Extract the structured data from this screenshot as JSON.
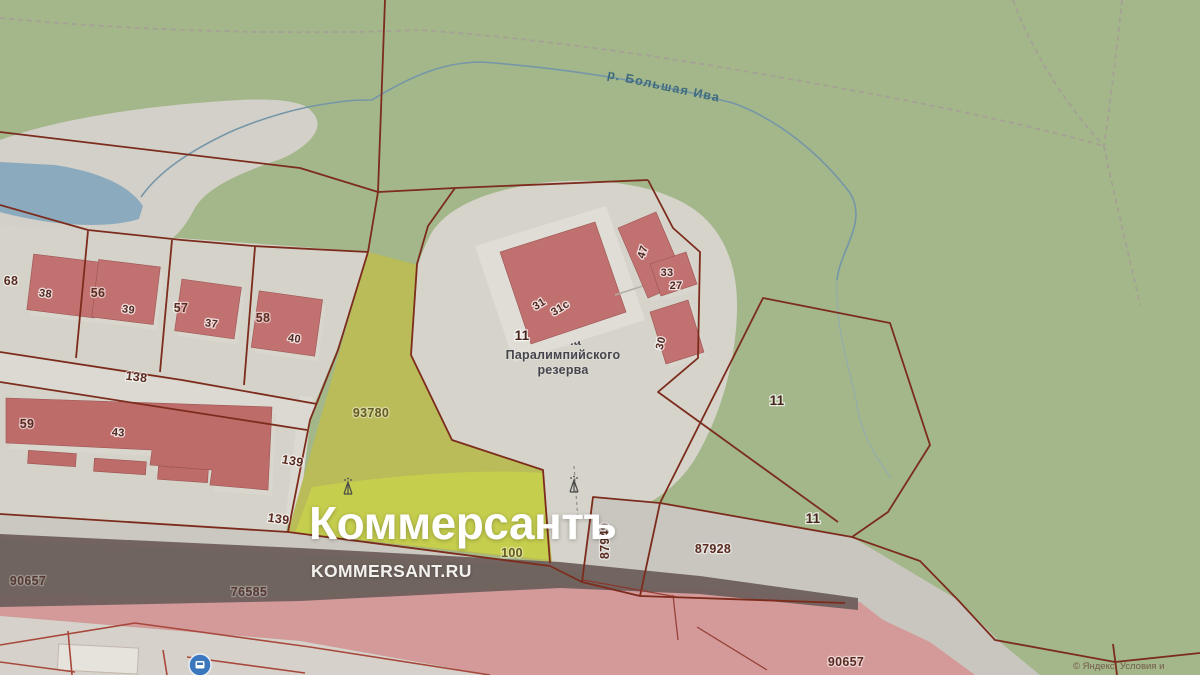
{
  "watermark": {
    "title": "Коммерсантъ",
    "site": "KOMMERSANT.RU"
  },
  "map": {
    "river_label": "р. Большая Ива",
    "school": {
      "line1": "Школа",
      "line2": "Паралимпийского",
      "line3": "резерва"
    },
    "copyright": "© Яндекс. Условия и",
    "colors": {
      "green": "#a3b78a",
      "urban": "#d5d2ca",
      "building": "#c17170",
      "cadastral": "#7c2c1c",
      "cadastral-bright": "#a8483c",
      "parcel-yellow": "#b9bc58",
      "parcel-yellow-bright": "#c6ce4e",
      "water": "#8caabe",
      "river": "#7596a8",
      "road-dark": "#6e5f5c",
      "road-pink": "#d49a9a"
    },
    "labels": [
      {
        "n": "parcel-label-68",
        "t": "68",
        "x": 11,
        "y": 285,
        "c": "parcel"
      },
      {
        "n": "building-label-38",
        "t": "38",
        "x": 45,
        "y": 297,
        "r": 8,
        "c": "bld"
      },
      {
        "n": "parcel-label-56",
        "t": "56",
        "x": 98,
        "y": 297,
        "c": "parcel"
      },
      {
        "n": "building-label-39",
        "t": "39",
        "x": 128,
        "y": 313,
        "r": 8,
        "c": "bld"
      },
      {
        "n": "parcel-label-57",
        "t": "57",
        "x": 181,
        "y": 312,
        "c": "parcel"
      },
      {
        "n": "building-label-37",
        "t": "37",
        "x": 211,
        "y": 327,
        "r": 8,
        "c": "bld"
      },
      {
        "n": "parcel-label-58",
        "t": "58",
        "x": 263,
        "y": 322,
        "c": "parcel"
      },
      {
        "n": "building-label-40",
        "t": "40",
        "x": 294,
        "y": 342,
        "r": 8,
        "c": "bld"
      },
      {
        "n": "road-label-138",
        "t": "138",
        "x": 136,
        "y": 381,
        "r": 7,
        "c": "parcel"
      },
      {
        "n": "parcel-label-59",
        "t": "59",
        "x": 27,
        "y": 428,
        "c": "parcel"
      },
      {
        "n": "building-label-43",
        "t": "43",
        "x": 118,
        "y": 436,
        "r": 4,
        "c": "bld"
      },
      {
        "n": "road-label-139",
        "t": "139",
        "x": 292,
        "y": 465,
        "r": 10,
        "c": "parcel"
      },
      {
        "n": "road-label-139-2",
        "t": "139",
        "x": 278,
        "y": 523,
        "r": 8,
        "c": "parcel"
      },
      {
        "n": "parcel-label-93780",
        "t": "93780",
        "x": 371,
        "y": 417,
        "c": "parcel olive"
      },
      {
        "n": "parcel-label-100",
        "t": "100",
        "x": 512,
        "y": 557,
        "c": "parcel olive"
      },
      {
        "n": "building-label-31",
        "t": "31",
        "x": 541,
        "y": 307,
        "r": -32,
        "c": "bld"
      },
      {
        "n": "building-label-31s",
        "t": "31с",
        "x": 562,
        "y": 311,
        "r": -32,
        "c": "bld"
      },
      {
        "n": "parcel-label-11-school",
        "t": "11",
        "x": 522,
        "y": 340,
        "c": "parcel big"
      },
      {
        "n": "building-label-47",
        "t": "47",
        "x": 646,
        "y": 253,
        "r": -72,
        "c": "bld"
      },
      {
        "n": "building-label-33",
        "t": "33",
        "x": 667,
        "y": 276,
        "c": "bld"
      },
      {
        "n": "building-label-27",
        "t": "27",
        "x": 676,
        "y": 289,
        "c": "bld"
      },
      {
        "n": "building-label-30",
        "t": "30",
        "x": 664,
        "y": 344,
        "r": -75,
        "c": "bld"
      },
      {
        "n": "parcel-label-11-park",
        "t": "11",
        "x": 777,
        "y": 405,
        "c": "parcel big"
      },
      {
        "n": "parcel-label-11-strip",
        "t": "11",
        "x": 813,
        "y": 523,
        "c": "parcel big"
      },
      {
        "n": "parcel-label-87928",
        "t": "87928",
        "x": 713,
        "y": 553,
        "c": "parcel"
      },
      {
        "n": "parcel-label-87949",
        "t": "87949",
        "x": 609,
        "y": 541,
        "r": -90,
        "c": "parcel"
      },
      {
        "n": "parcel-label-90657",
        "t": "90657",
        "x": 28,
        "y": 585,
        "c": "parcel dim"
      },
      {
        "n": "parcel-label-76585",
        "t": "76585",
        "x": 249,
        "y": 596,
        "c": "parcel dim"
      },
      {
        "n": "parcel-label-90657-2",
        "t": "90657",
        "x": 846,
        "y": 666,
        "c": "parcel"
      }
    ]
  }
}
